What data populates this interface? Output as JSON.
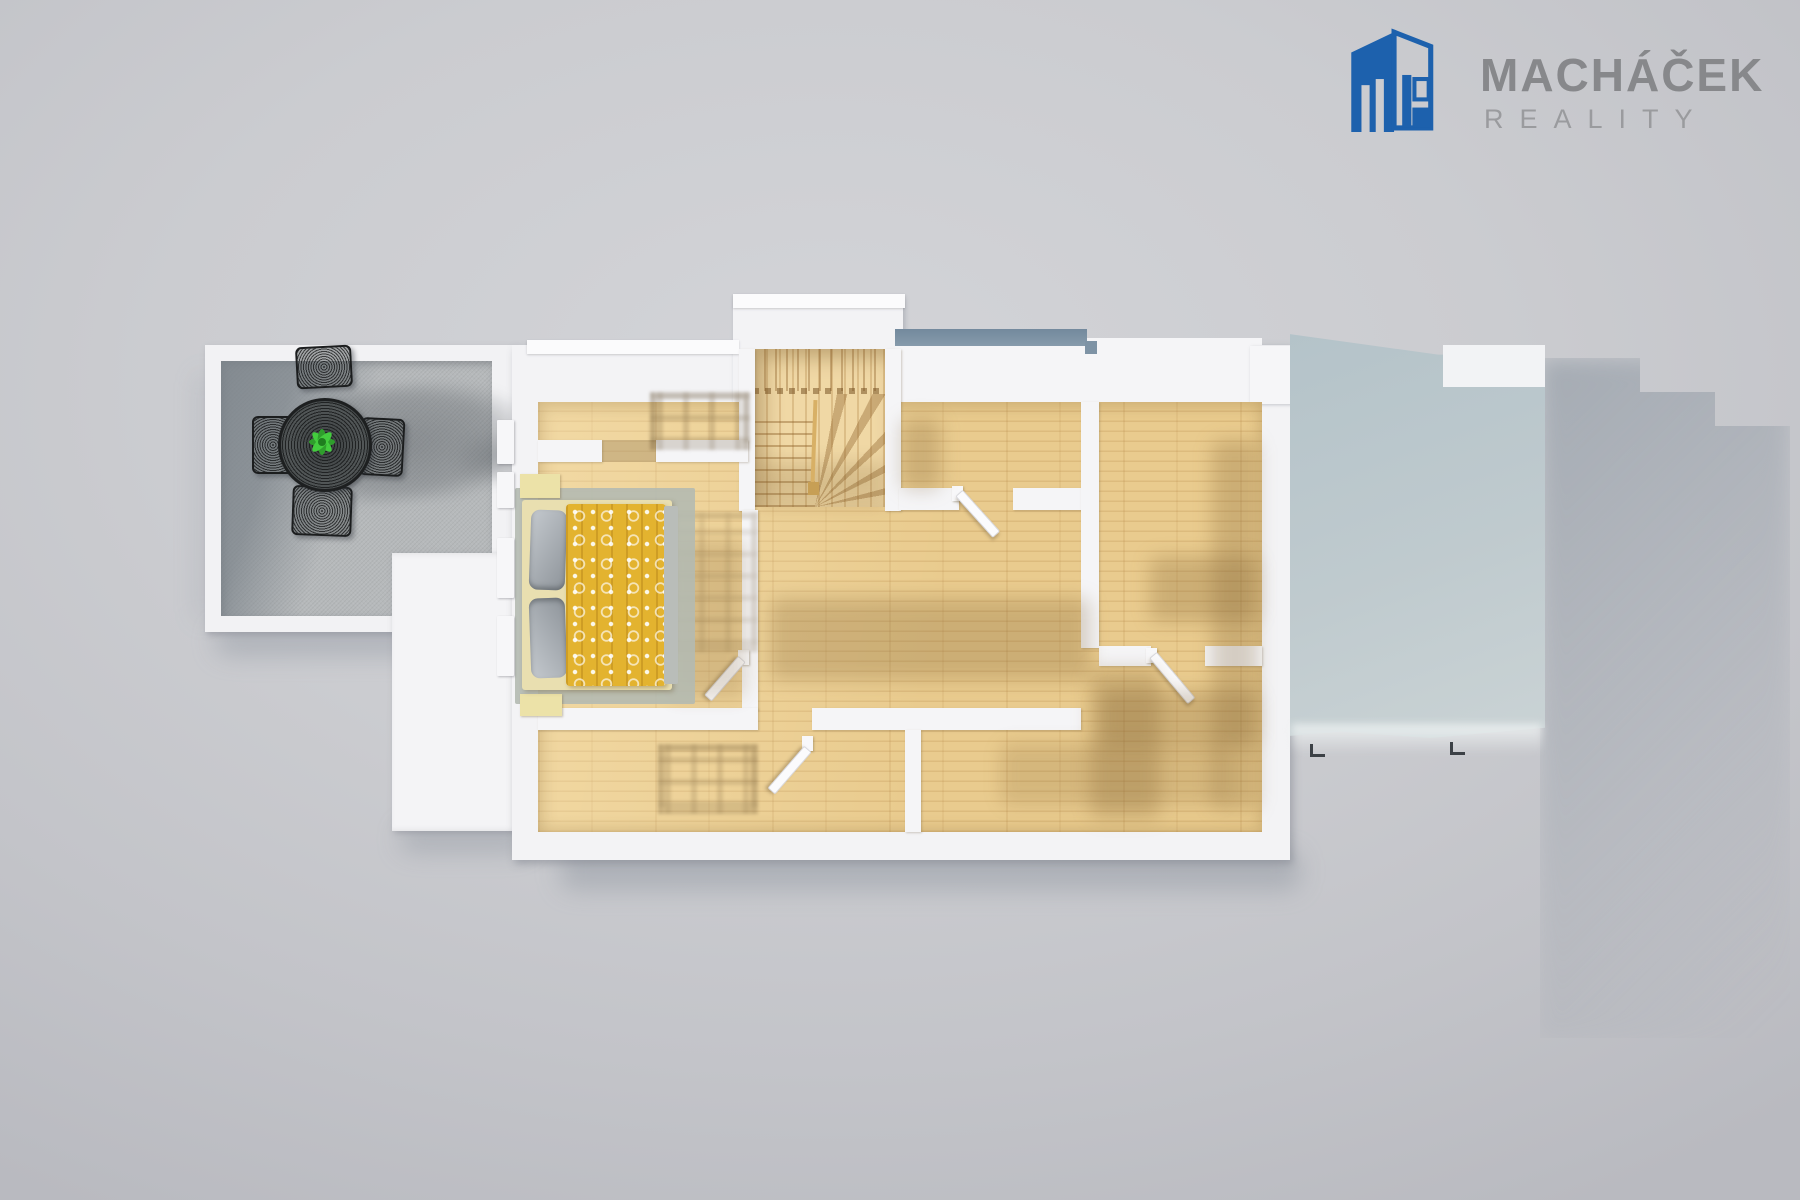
{
  "brand": {
    "name": "MACHÁČEK",
    "subtitle": "REALITY",
    "name_color": "#87888b",
    "subtitle_color": "#9a9b9e",
    "icon_color": "#1d61ad"
  },
  "scene": {
    "type": "3d-floorplan-top-view-render",
    "background_color": "#cbccd0",
    "wall_color": "#f5f5f7",
    "wood_floor_color": "#e9cb8e",
    "stair_wood_color": "#f0d8a5",
    "terrace_floor_color": "#b6b9bb",
    "annex_roof_color": "#bcc9cd",
    "low_roof_color": "#f4f4f6",
    "duvet_color": "#e3b32f",
    "pillow_color": "#a6abb1",
    "rug_color": "#b4bab1",
    "plant_color": "#3fcf3a",
    "furniture_color": "#232526",
    "objects": [
      "terrace",
      "outdoor-dining-set",
      "potted-plant",
      "wooden-staircase",
      "double-bed-yellow-duvet",
      "nightstands",
      "open-doors",
      "flat-roof-white",
      "flat-roof-blue-gray",
      "window-shadows"
    ]
  }
}
